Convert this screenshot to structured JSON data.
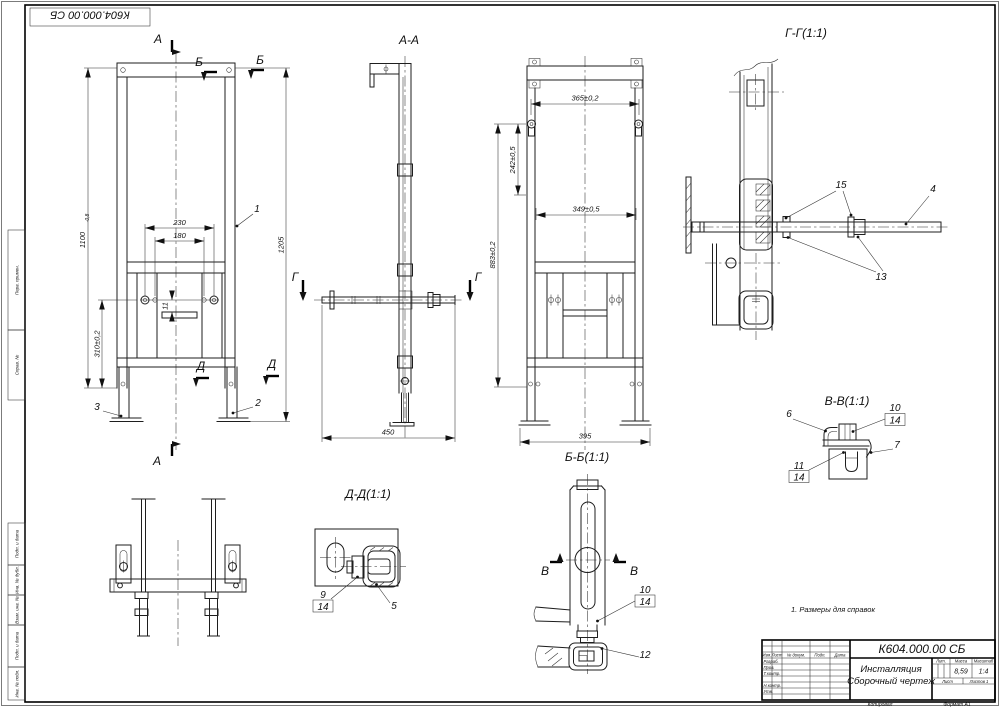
{
  "corner_stamp": "К604.000.00 СБ",
  "note": "1. Размеры для справок",
  "front_view": {
    "section_a": "А",
    "section_b": "Б",
    "section_d": "Д",
    "dim_h_main": "1100",
    "dim_h_tol": "-0,8",
    "dim_1205": "1205",
    "dim_230": "230",
    "dim_180": "180",
    "dim_11": "11",
    "dim_310": "310±0,2",
    "balloon_1": "1",
    "balloon_2": "2",
    "balloon_3": "3"
  },
  "view_aa": {
    "label": "А-А",
    "section_g": "Г",
    "dim_450": "450"
  },
  "view_bb": {
    "label": "Б-Б(1:1)",
    "dim_365": "365±0,2",
    "dim_242": "242±0,5",
    "dim_349": "349±0,5",
    "dim_883": "883±0,2",
    "dim_395": "395"
  },
  "view_gg": {
    "label": "Г-Г(1:1)",
    "balloon_15": "15",
    "balloon_4": "4",
    "balloon_13": "13"
  },
  "view_vv": {
    "label": "В-В(1:1)",
    "balloon_6": "6",
    "balloon_10": "10",
    "balloon_14": "14",
    "balloon_7": "7",
    "balloon_11": "11"
  },
  "view_dd": {
    "label": "Д-Д(1:1)",
    "balloon_9": "9",
    "balloon_14": "14",
    "balloon_5": "5"
  },
  "view_leg": {
    "section_v": "В",
    "balloon_10": "10",
    "balloon_14": "14",
    "balloon_12": "12"
  },
  "title_block": {
    "doc_number": "К604.000.00 СБ",
    "name_line1": "Инсталляция",
    "name_line2": "Сборочный чертеж",
    "mass": "8,59",
    "scale": "1:4",
    "hdr_izm": "Изм.",
    "hdr_list": "Лист",
    "hdr_doc": "№ докум.",
    "hdr_podp": "Подп.",
    "hdr_data": "Дата",
    "row_razrab": "Разраб.",
    "row_prov": "Пров.",
    "row_tkontr": "Т.контр.",
    "row_nkontr": "Н.контр.",
    "row_utv": "Утв.",
    "lbl_lit": "Лит.",
    "lbl_mass": "Масса",
    "lbl_scale": "Масштаб",
    "lbl_list": "Лист",
    "lbl_listov": "Листов 1",
    "copied": "Копировал",
    "format": "Формат A1"
  },
  "margin_labels": {
    "perv_primen": "Перв. примен.",
    "sprav_no": "Справ. №",
    "podp_data1": "Подп. и дата",
    "inv_dubl": "Инв. № дубл.",
    "vzam_inv": "Взам. инв. №",
    "podp_data2": "Подп. и дата",
    "inv_podl": "Инв. № подл."
  }
}
